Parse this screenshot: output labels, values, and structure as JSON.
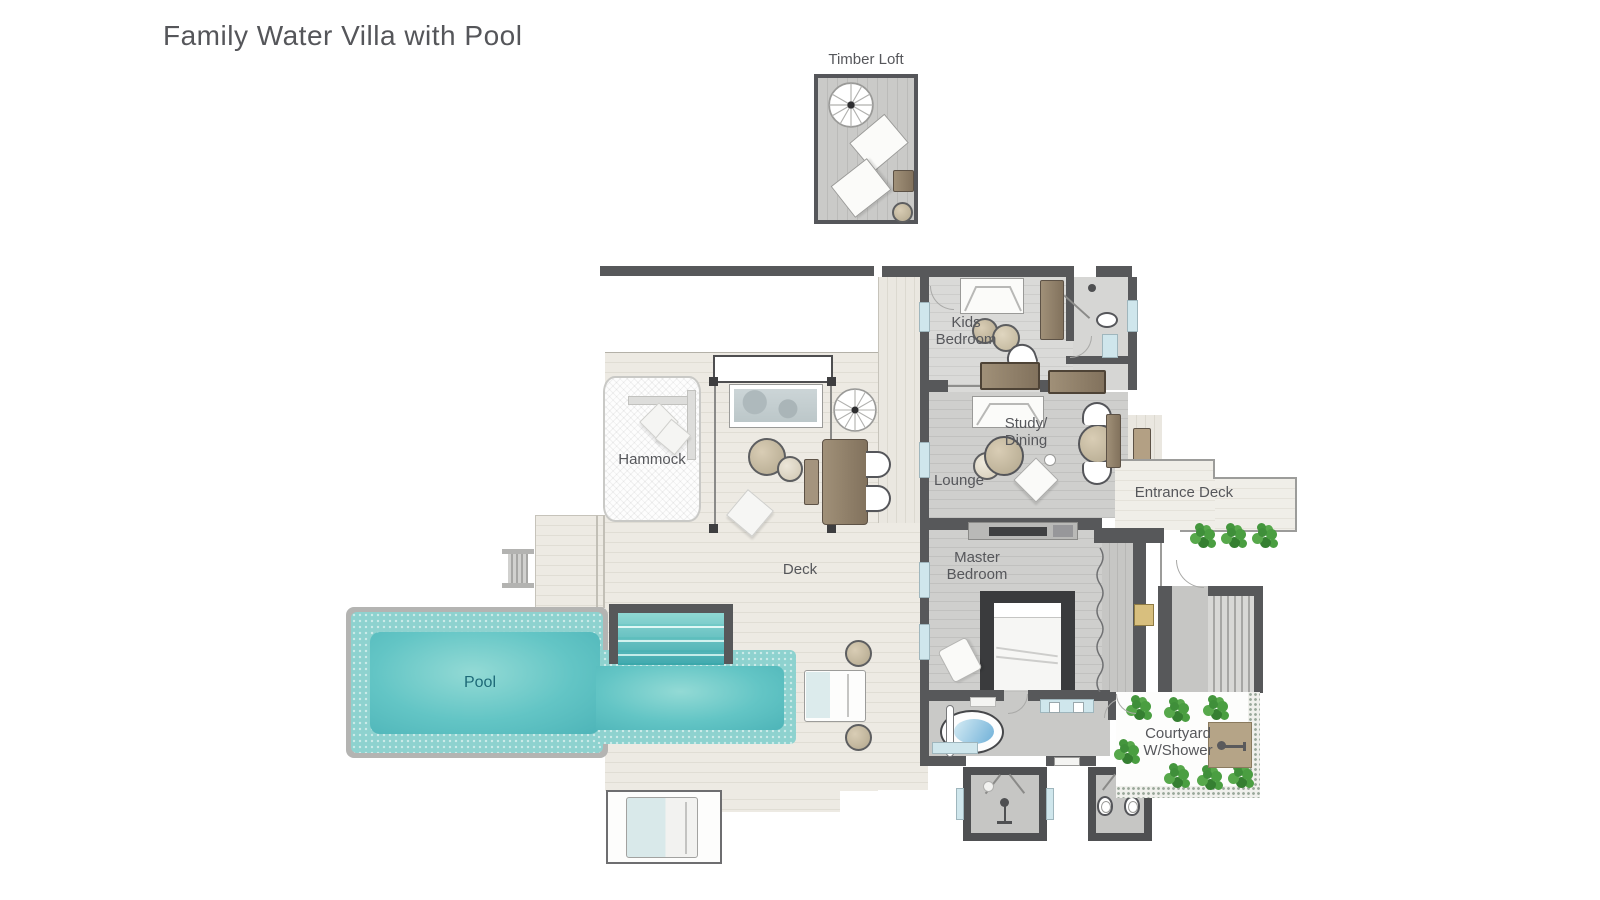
{
  "title": "Family Water Villa with Pool",
  "rooms": {
    "timber_loft": "Timber Loft",
    "kids_bedroom": "Kids Bedroom",
    "study_dining": "Study/ Dining",
    "lounge": "Lounge",
    "hammock": "Hammock",
    "deck": "Deck",
    "entrance_deck": "Entrance Deck",
    "master_bedroom": "Master Bedroom",
    "pool": "Pool",
    "courtyard": "Courtyard W/Shower"
  },
  "colors": {
    "wall": "#57585a",
    "pool_water": "#56bcbe",
    "pool_tile": "#8ed2cf",
    "deck_floor": "#edeae3",
    "interior_floor": "#cbcbc9",
    "furniture_brown": "#94826c",
    "plant_green": "#3f8f3a",
    "label_text": "#56575b",
    "pool_label_text": "#1e6a78",
    "window_blue": "#cfe6ec"
  }
}
